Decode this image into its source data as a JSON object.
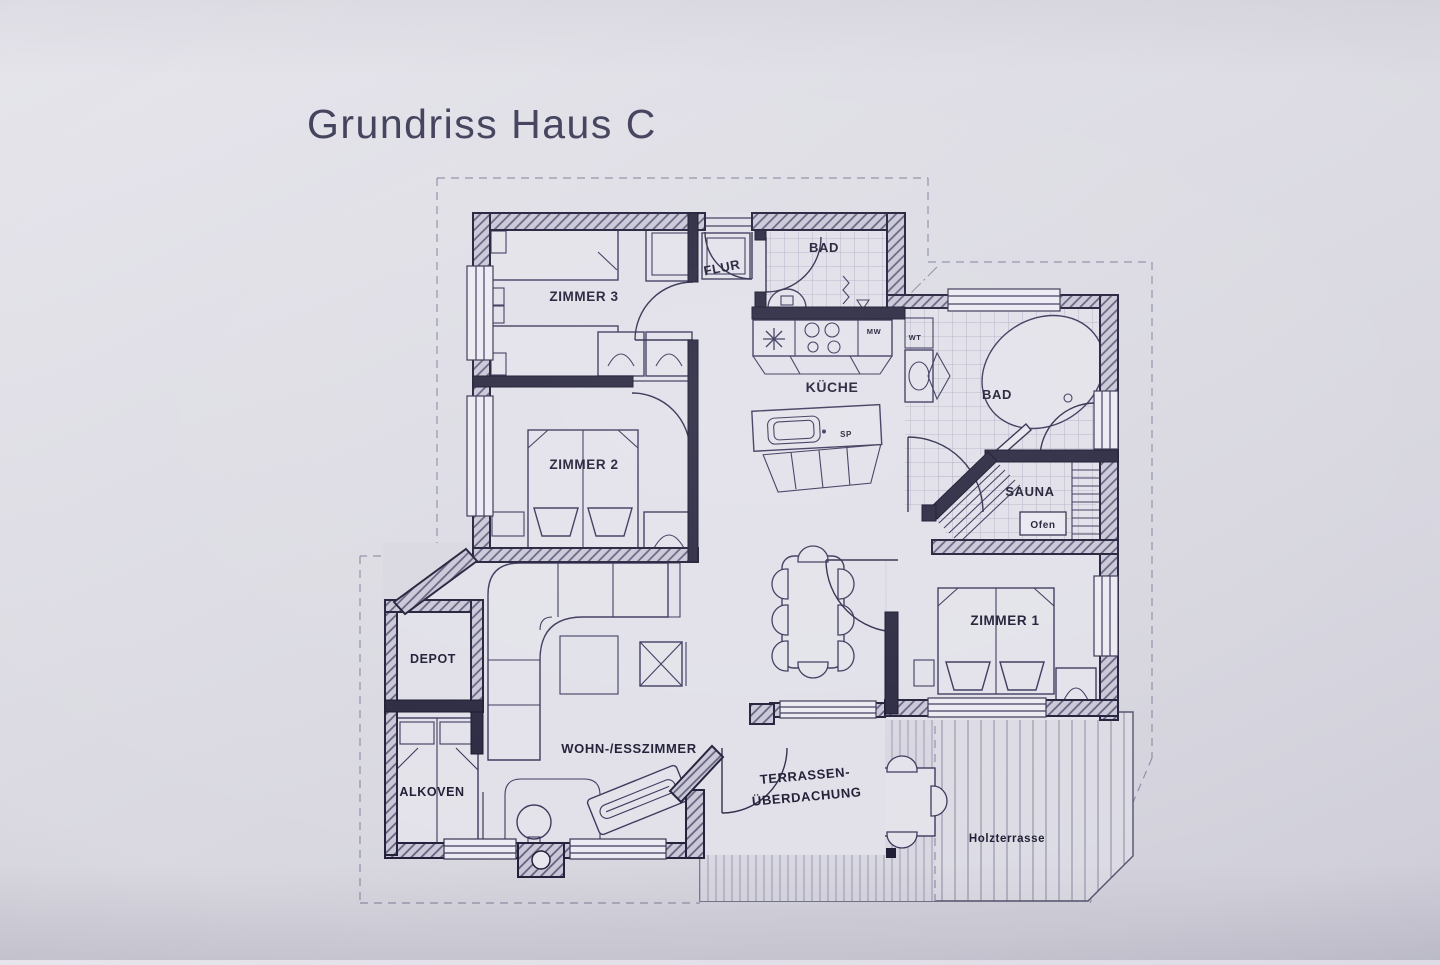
{
  "title": "Grundriss Haus C",
  "rooms": {
    "zimmer3": "ZIMMER 3",
    "zimmer2": "ZIMMER 2",
    "zimmer1": "ZIMMER 1",
    "flur": "FLUR",
    "bad_top": "BAD",
    "bad_right": "BAD",
    "kueche": "KÜCHE",
    "sauna": "SAUNA",
    "depot": "DEPOT",
    "alkoven": "ALKOVEN",
    "wohn_esszimmer": "WOHN-/ESSZIMMER",
    "terrasse_line1": "TERRASSEN-",
    "terrasse_line2": "ÜBERDACHUNG",
    "holzterrasse": "Holzterrasse"
  },
  "appliances": {
    "ofen": "Ofen",
    "mw": "MW",
    "wt": "WT",
    "sp": "SP"
  },
  "colors": {
    "paper": "#d9d8e1",
    "interior": "#e1e0e9",
    "wall": "#29273f",
    "ink": "#1d1b33"
  }
}
